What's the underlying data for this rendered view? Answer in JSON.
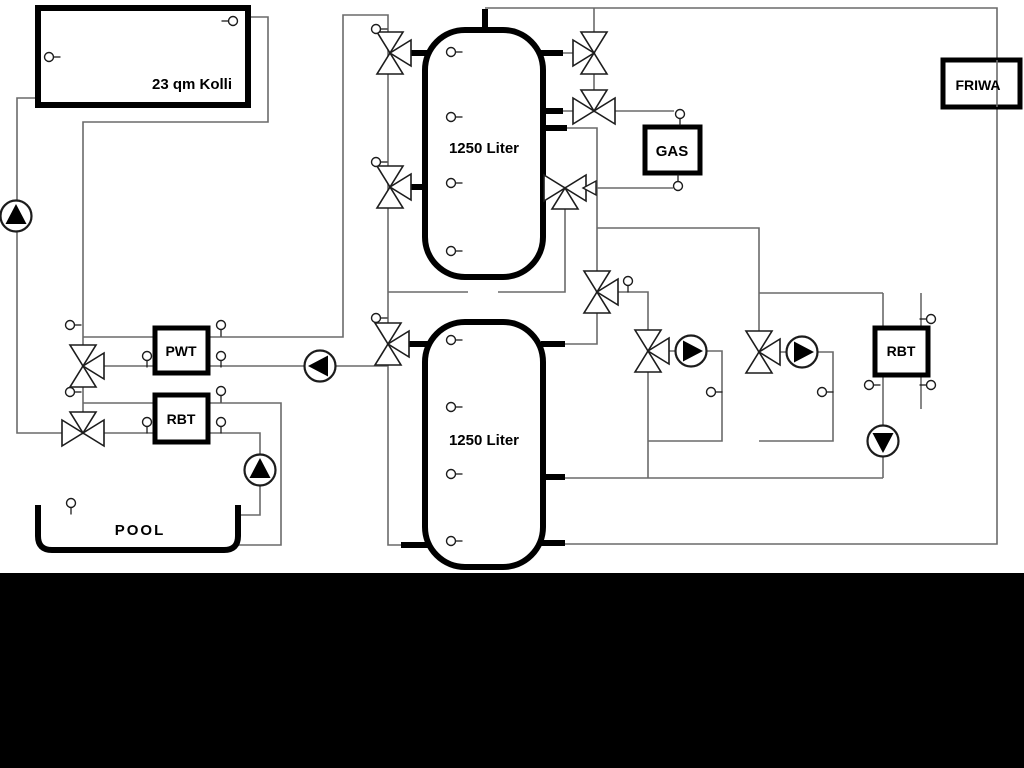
{
  "scene": {
    "type": "hydraulic-heating-schematic",
    "background": "#ffffff",
    "bottom_bar_color": "#000000"
  },
  "colors": {
    "pipe_thin": "#6a6a6a",
    "pipe_thick": "#000000",
    "box_border": "#000000",
    "symbol_fill": "#ffffff",
    "symbol_stroke": "#1c1c1c",
    "pump_arrow": "#000000"
  },
  "labels": {
    "collector": "23 qm Kolli",
    "tank_upper": "1250 Liter",
    "tank_lower": "1250 Liter",
    "gas": "GAS",
    "friwa": "FRIWA",
    "pwt": "PWT",
    "rbt_left": "RBT",
    "rbt_right": "RBT",
    "pool": "POOL"
  },
  "equipment": {
    "tanks": [
      {
        "name": "buffer-tank-upper",
        "capacity_label": "1250 Liter",
        "sensor_count": 4
      },
      {
        "name": "buffer-tank-lower",
        "capacity_label": "1250 Liter",
        "sensor_count": 4
      }
    ],
    "pumps": [
      {
        "name": "solar-pump",
        "direction": "up"
      },
      {
        "name": "pwt-charge-pump",
        "direction": "left"
      },
      {
        "name": "pool-pump",
        "direction": "up"
      },
      {
        "name": "heating-circuit-pump-1",
        "direction": "right"
      },
      {
        "name": "heating-circuit-pump-2",
        "direction": "right"
      },
      {
        "name": "rbt-circulation-pump",
        "direction": "down"
      }
    ],
    "valves": [
      "tank-left-top-valve",
      "tank-left-mid-valve",
      "tank-left-lower-valve",
      "pwt-mixing-valve",
      "pool-rbt-mixing-valve",
      "gas-top-valve",
      "gas-mid-valve",
      "gas-return-valve",
      "tank-right-mixing-valve",
      "heating-mixer-1",
      "heating-mixer-2"
    ],
    "symbols": {
      "pump": "circle-with-solid-triangle",
      "valve": "three-way-bowtie-valve",
      "sensor": "small-circle-nipple",
      "flow_arrow": "open-left-arrowhead"
    },
    "sensor_count": 30
  }
}
